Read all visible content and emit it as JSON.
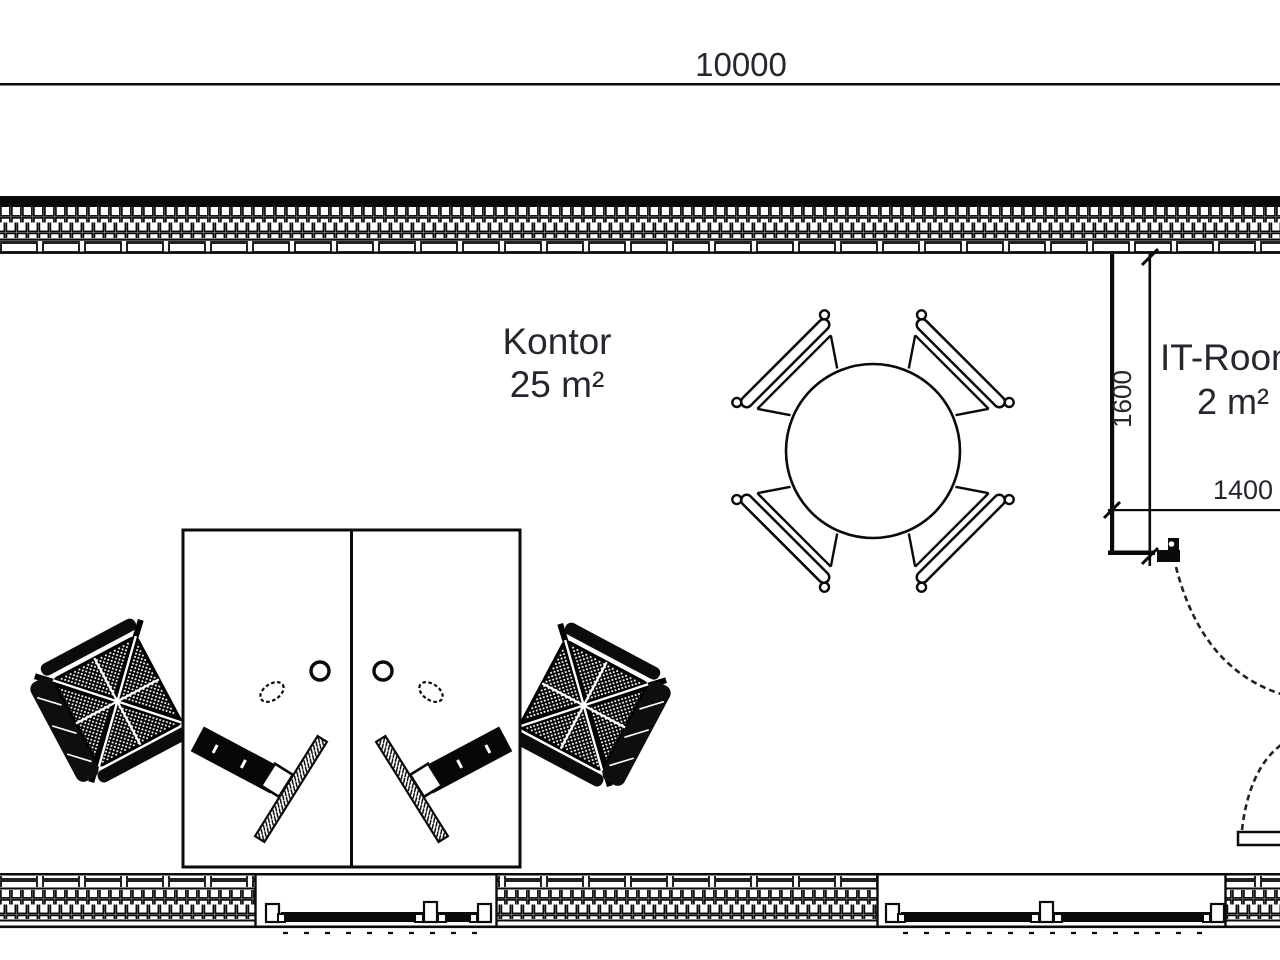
{
  "drawing": {
    "type": "floor-plan",
    "overall_dimension": "10000",
    "rooms": [
      {
        "name": "Kontor",
        "area": "25 m²"
      },
      {
        "name": "IT-Room",
        "area": "2 m²"
      }
    ],
    "dimensions": {
      "total_width": "10000",
      "it_room_depth": "1600",
      "it_room_width": "1400"
    },
    "furniture": {
      "meeting_table": "round table with 4 chairs",
      "workstations": "2 mirrored desks with office chair, monitor, keyboard, mouse, cup",
      "doors": "2 swing doors",
      "windows": "2 window bands in bottom wall"
    },
    "colors": {
      "line": "#0a0a0a",
      "text": "#26262e",
      "background": "#ffffff"
    }
  }
}
